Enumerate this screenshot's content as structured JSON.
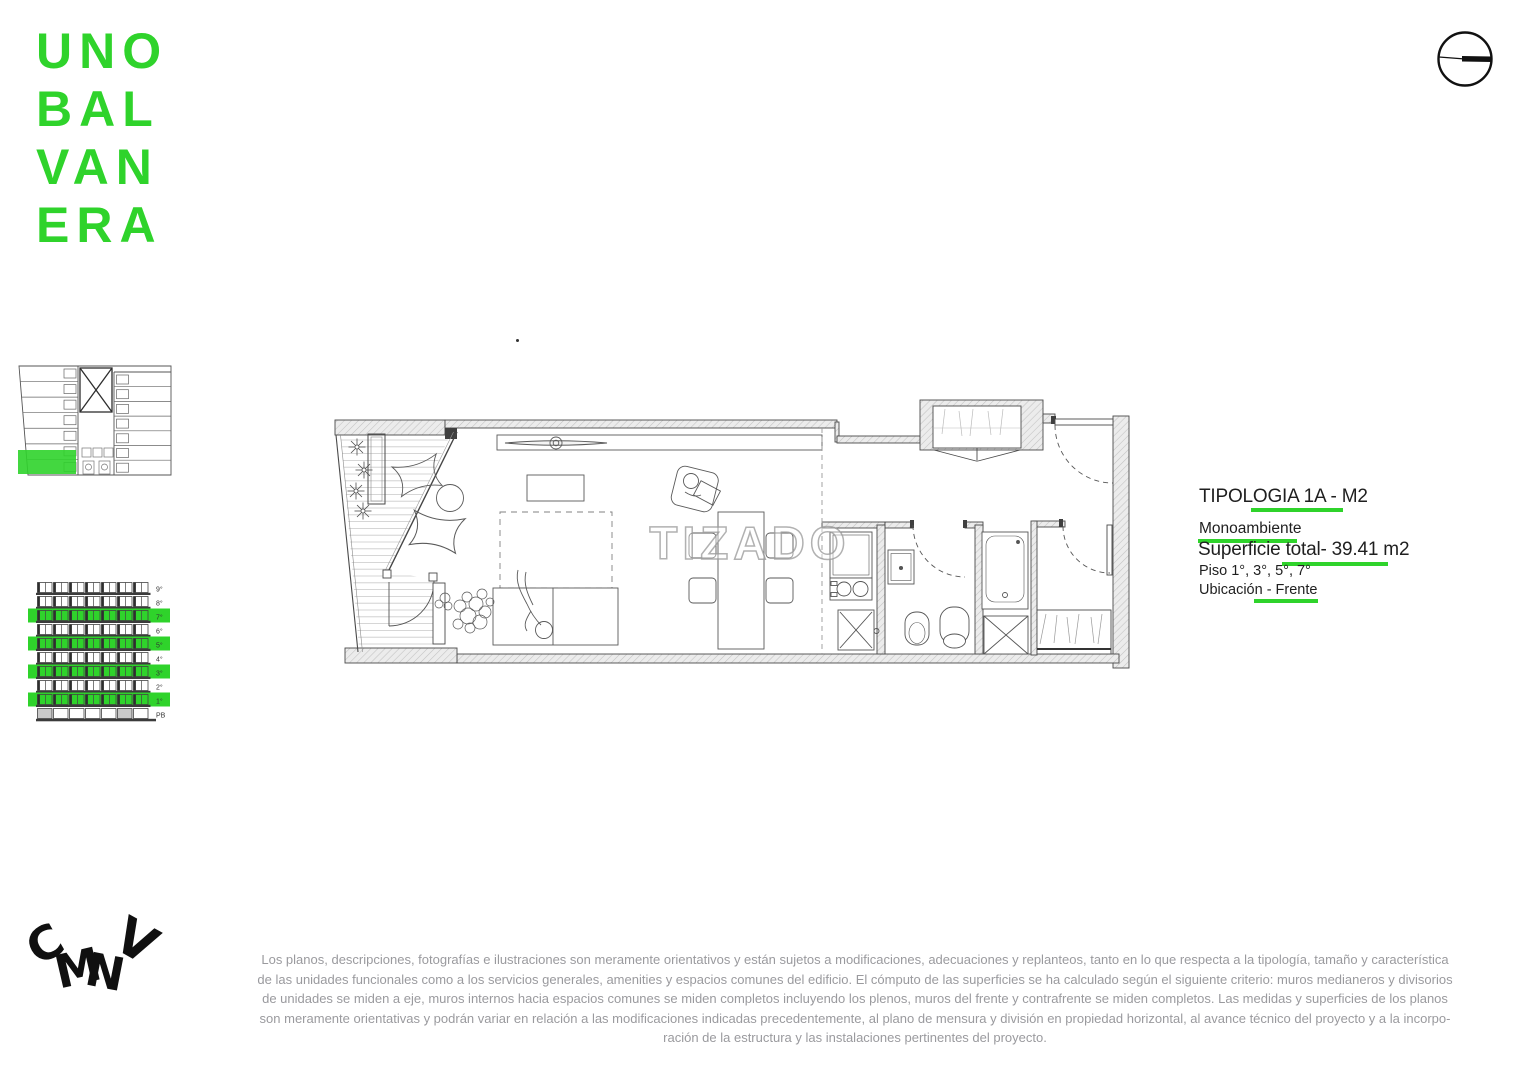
{
  "colors": {
    "brand_green": "#2fd32b",
    "text_dark": "#1f1f1f",
    "text_gray": "#9a9a9e",
    "plan_stroke": "#4a4a4a"
  },
  "brand": {
    "logo_lines": [
      "UNO",
      "BAL",
      "VAN",
      "ERA"
    ],
    "footer_letters": [
      "C",
      "M",
      "N",
      "V"
    ]
  },
  "info_panel": {
    "title": "TIPOLOGIA 1A - M2",
    "subtitle": "Monoambiente",
    "area": "Superficie total- 39.41 m2",
    "floors": "Piso 1°, 3°, 5°, 7°",
    "location": "Ubicación - Frente"
  },
  "floor_plan": {
    "watermark": "TIZADO"
  },
  "elevation": {
    "floor_labels": [
      "9°",
      "8°",
      "7°",
      "6°",
      "5°",
      "4°",
      "3°",
      "2°",
      "1°",
      "PB"
    ],
    "highlighted_floors": [
      "7°",
      "5°",
      "3°",
      "1°"
    ]
  },
  "disclaimer": {
    "lines": [
      "Los planos, descripciones, fotografías e ilustraciones son meramente orientativos y están sujetos a modificaciones, adecuaciones y replanteos, tanto en lo que respecta a la tipología, tamaño y característica",
      "de las unidades funcionales como a los servicios generales, amenities y espacios comunes del edificio. El cómputo de las superficies se ha calculado según el siguiente criterio: muros medianeros y divisorios",
      "de unidades se miden a eje, muros internos hacia espacios comunes se miden completos incluyendo los plenos, muros del frente y contrafrente se miden completos. Las medidas y superficies de los planos",
      "son meramente orientativas y podrán variar en relación a las modificaciones indicadas precedentemente, al plano de mensura y división en propiedad horizontal, al avance técnico del proyecto y a la incorpo-",
      "ración de la estructura y las instalaciones pertinentes del proyecto."
    ]
  }
}
